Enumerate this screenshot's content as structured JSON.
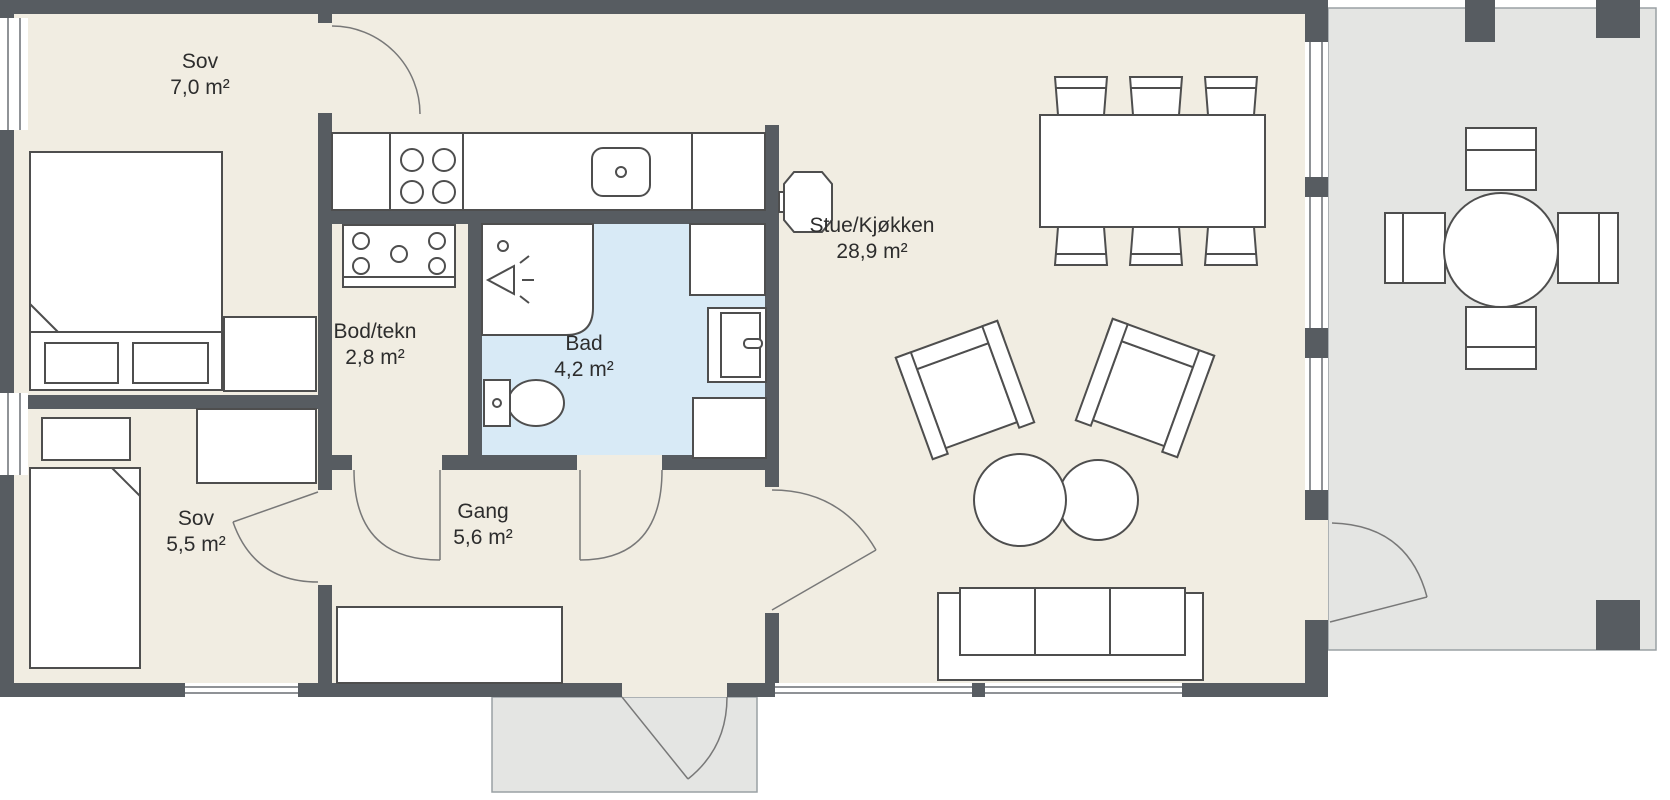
{
  "rooms": [
    {
      "id": "sov-1",
      "name": "Sov",
      "area": "7,0 m²"
    },
    {
      "id": "bod-tekn",
      "name": "Bod/tekn",
      "area": "2,8 m²"
    },
    {
      "id": "bad",
      "name": "Bad",
      "area": "4,2 m²"
    },
    {
      "id": "stue-kjokken",
      "name": "Stue/Kjøkken",
      "area": "28,9 m²"
    },
    {
      "id": "sov-2",
      "name": "Sov",
      "area": "5,5 m²"
    },
    {
      "id": "gang",
      "name": "Gang",
      "area": "5,6 m²"
    }
  ],
  "colors": {
    "wall": "#575C61",
    "floor": "#F1EDE2",
    "bathroom_floor": "#D8EAF6",
    "terrace": "#E4E5E3",
    "furniture_outline": "#4E4E4E",
    "background": "#FFFFFF"
  }
}
